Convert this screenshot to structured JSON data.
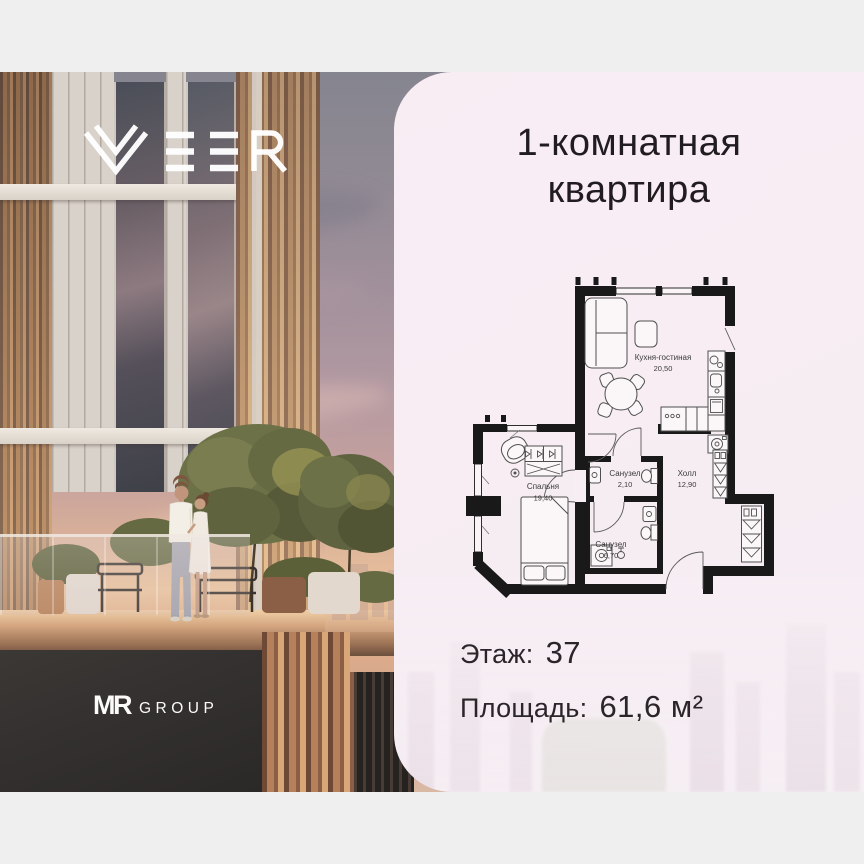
{
  "branding": {
    "veer_text": "VEER",
    "developer_mr": "MR",
    "developer_group": "GROUP"
  },
  "card": {
    "title_line1": "1-комнатная",
    "title_line2": "квартира",
    "floor_label": "Этаж:",
    "floor_value": "37",
    "area_label": "Площадь:",
    "area_value": "61,6 м²"
  },
  "floor_plan": {
    "rooms": [
      {
        "name": "Кухня-гостиная",
        "area": "20,50"
      },
      {
        "name": "Спальня",
        "area": "19,40"
      },
      {
        "name": "Санузел",
        "area": "2,10"
      },
      {
        "name": "Санузел",
        "area": "6,70"
      },
      {
        "name": "Холл",
        "area": "12,90"
      }
    ]
  }
}
